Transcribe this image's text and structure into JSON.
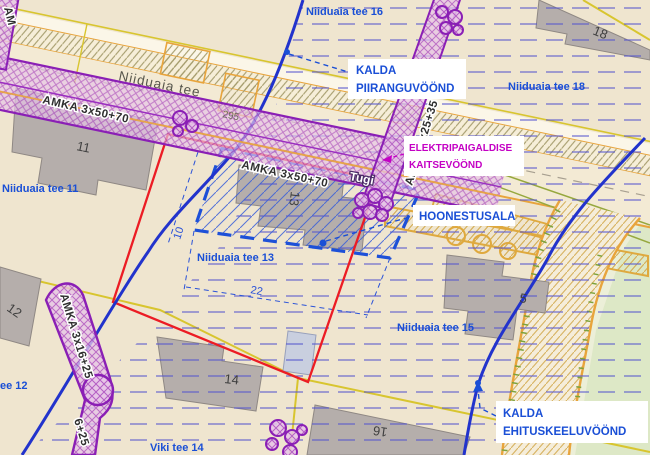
{
  "map": {
    "streets": {
      "niiduaia_tee": "Niiduaia tee",
      "viki_tee": "Viki tee 14",
      "road_number": "295"
    },
    "parcels": {
      "tee_16": "Niiduaia tee 16",
      "tee_18": "Niiduaia tee 18",
      "tee_11": "Niiduaia tee 11",
      "tee_13": "Niiduaia tee 13",
      "tee_15": "Niiduaia tee 15",
      "tee_12_partial": "ee 12"
    },
    "buildings": {
      "b11": "11",
      "b12": "12",
      "b13": "13",
      "b14": "14",
      "b16": "16",
      "b18": "18",
      "b5": "5"
    },
    "cables": {
      "amka_50_70_west": "AMKA 3x50+70",
      "amka_50_70_mid": "AMKA 3x50+70",
      "amka_25_35": "AMKA 3x25+35",
      "amka_16_25": "AMKA 3x16+25",
      "amka_16_25_partial": "6+25",
      "amka_partial_left": "AM",
      "support": "Tugi"
    },
    "dimensions": {
      "width": "10",
      "length": "22"
    },
    "callouts": {
      "piiranguvoond": {
        "line1": "KALDA",
        "line2": "PIIRANGUVÖÖND"
      },
      "kaitsevoond": {
        "line1": "ELEKTRIPAIGALDISE",
        "line2": "KAITSEVÖÖND"
      },
      "hoonestusala": {
        "label": "HOONESTUSALA"
      },
      "ehituskeeluvoond": {
        "line1": "KALDA",
        "line2": "EHITUSKEELUVÖÖND"
      }
    },
    "colors": {
      "label_blue": "#1a4fd6",
      "label_magenta": "#c400c4",
      "boundary_red": "#ec1c24",
      "boundary_blue": "#2233cc",
      "cable_purple": "#8a1fb5",
      "road_orange": "#e8a43c",
      "building_gray": "#b5aeab",
      "restriction_hatch_blue": "#5353cf",
      "grass_green": "#dde8c6",
      "background_beige": "#efe5cf"
    }
  }
}
